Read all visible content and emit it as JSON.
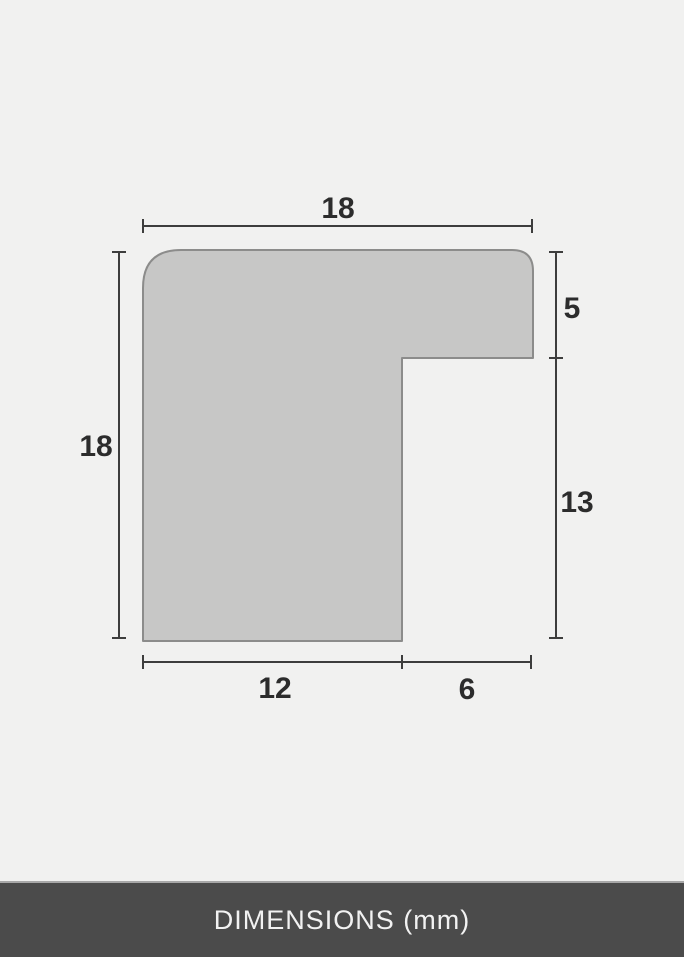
{
  "diagram": {
    "labels": {
      "top_width": "18",
      "left_height": "18",
      "right_upper": "5",
      "right_lower": "13",
      "bottom_left": "12",
      "bottom_right": "6"
    }
  },
  "footer": {
    "label": "DIMENSIONS (mm)"
  },
  "colors": {
    "page_background": "#f1f1f0",
    "shape_fill": "#c7c7c6",
    "shape_outline": "#8c8c8b",
    "dimension_line": "#3d3d3d",
    "dimension_text": "#2c2c2c",
    "footer_background": "#4b4b4b",
    "footer_text": "#f2f2f2",
    "footer_divider": "#a8a8a8"
  }
}
